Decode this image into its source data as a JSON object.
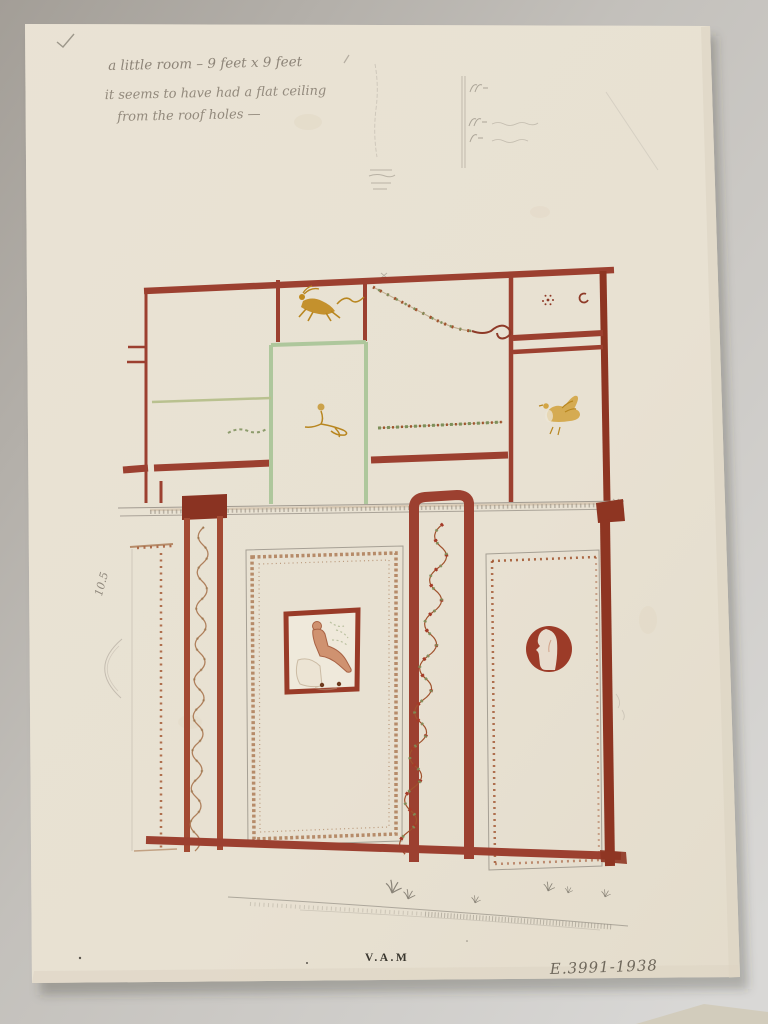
{
  "inscriptions": {
    "note_line1": "a little room – 9 feet x 9 feet",
    "note_line2": "it seems to have had a flat ceiling",
    "note_line3": "from the roof holes —",
    "margin_measurement": "10.5",
    "museum_stamp": "V.A.M",
    "accession_number": "E.3991-1938"
  },
  "colors": {
    "backdrop": "#b7b4af",
    "paper": "#e8e1d2",
    "red_ochre": "#9c4030",
    "dark_red": "#8e3522",
    "pale_green": "#aec79c",
    "olive_green": "#b9c18f",
    "leaf_green": "#7d8f5a",
    "ochre_yellow": "#c08a1e",
    "flesh_wash": "#cf9270",
    "pencil_gray": "#8f887c",
    "border_brown": "#a9764f"
  }
}
